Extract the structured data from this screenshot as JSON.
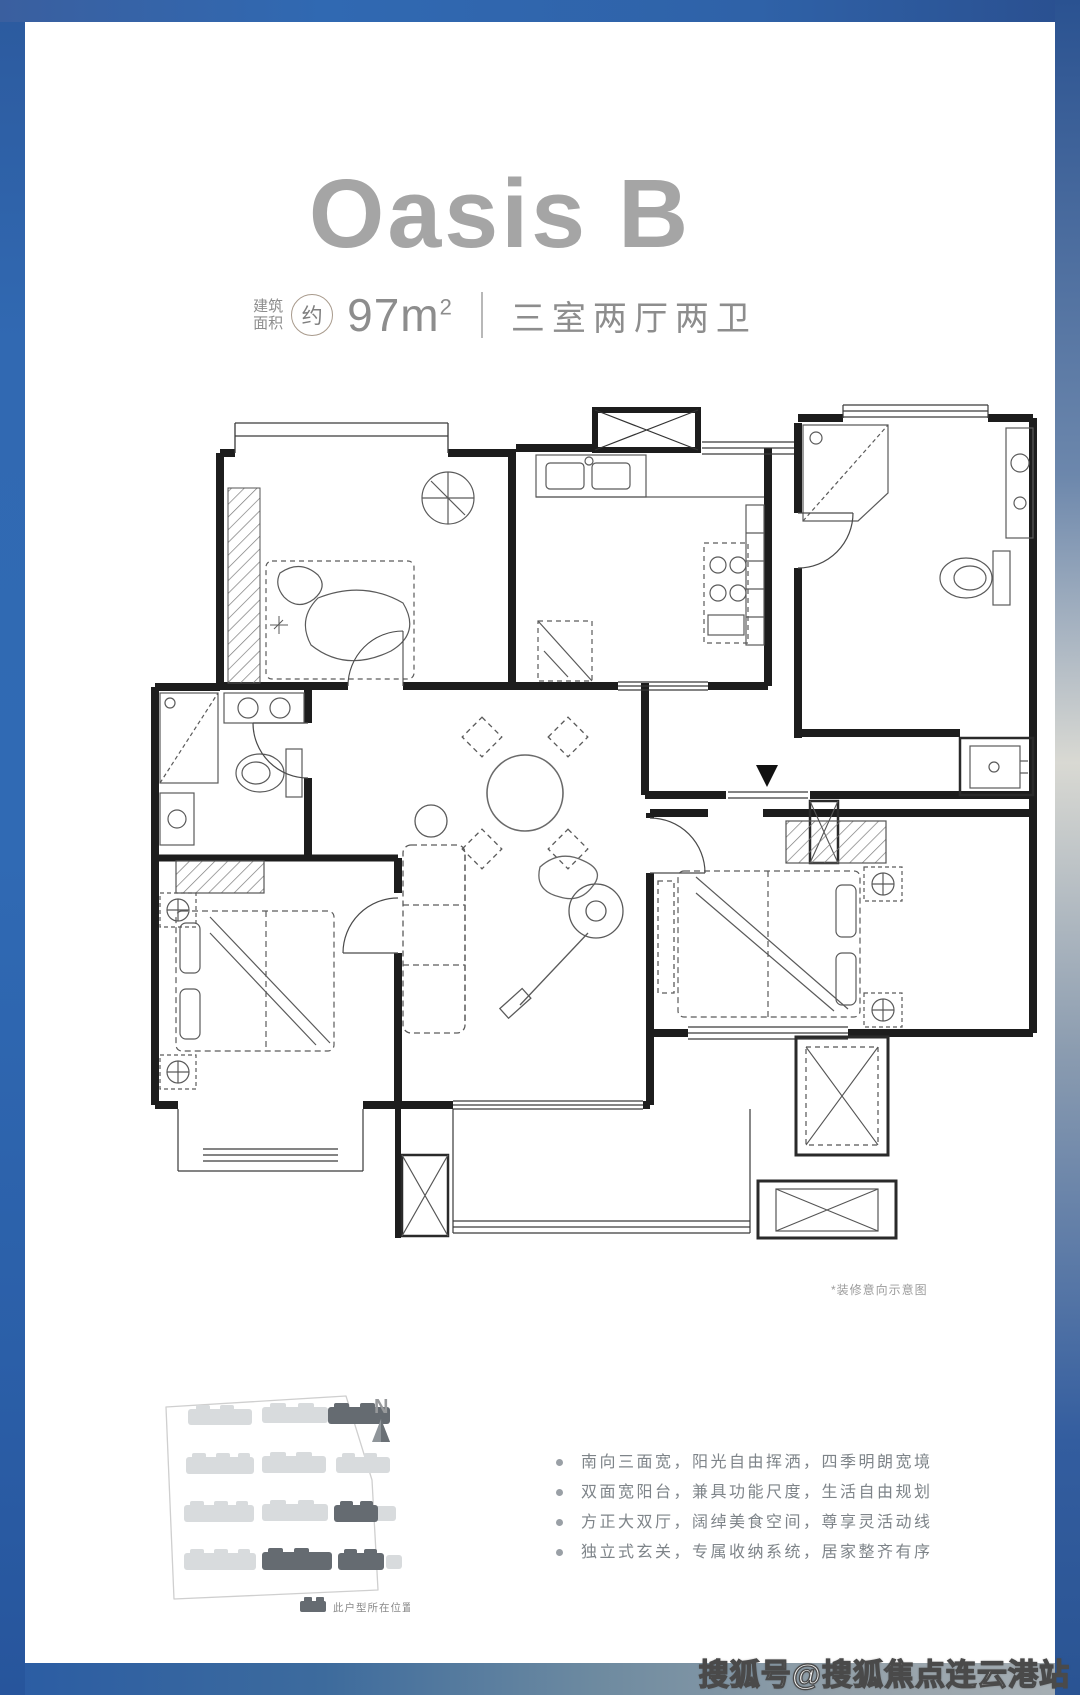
{
  "header": {
    "title": "Oasis B",
    "area_label_line1": "建筑",
    "area_label_line2": "面积",
    "area_circle": "约",
    "area_value": "97m",
    "area_sup": "2",
    "layout_text": "三室两厅两卫"
  },
  "floor_plan": {
    "disclaimer": "*装修意向示意图"
  },
  "site_plan": {
    "north_label": "N",
    "legend_text": "此户型所在位置",
    "building_light_color": "#d8dbdd",
    "building_dark_color": "#656b71"
  },
  "features": {
    "items": [
      "南向三面宽，阳光自由挥洒，四季明朗宽境",
      "双面宽阳台，兼具功能尺度，生活自由规划",
      "方正大双厅，阔绰美食空间，尊享灵活动线",
      "独立式玄关，专属收纳系统，居家整齐有序"
    ]
  },
  "watermark": {
    "text": "搜狐号@搜狐焦点连云港站"
  },
  "colors": {
    "frame_blue": "#2f67b0",
    "title_gray": "#a5a5a5",
    "text_gray": "#8d8d8d",
    "wall_black": "#1d1d1d"
  }
}
